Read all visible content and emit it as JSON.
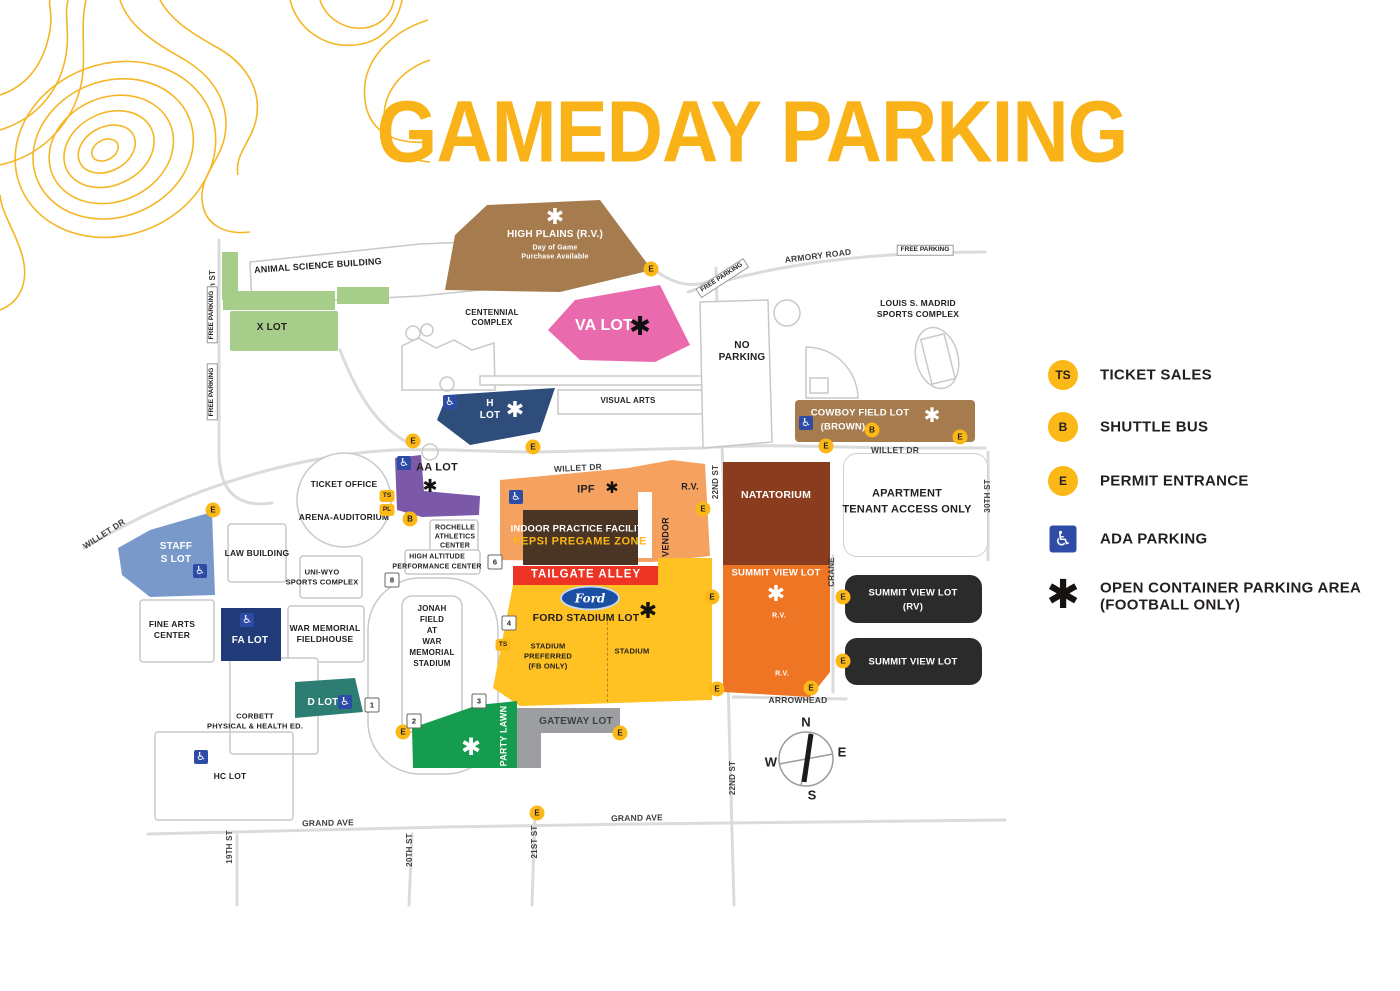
{
  "title": "GAMEDAY PARKING",
  "legend": {
    "ts_badge": "TS",
    "ts": "TICKET SALES",
    "b_badge": "B",
    "b": "SHUTTLE BUS",
    "e_badge": "E",
    "e": "PERMIT ENTRANCE",
    "ada": "ADA PARKING",
    "oc1": "OPEN CONTAINER PARKING AREA",
    "oc2": "(FOOTBALL ONLY)"
  },
  "markers": {
    "e": "E",
    "b": "B",
    "ts": "TS",
    "pl": "PL",
    "ada": "♿",
    "asterisk": "✱",
    "gate1": "1",
    "gate2": "2",
    "gate3": "3",
    "gate4": "4",
    "gate6": "6",
    "gate8": "8"
  },
  "lots": {
    "x": "X LOT",
    "hp_name": "HIGH PLAINS (R.V.)",
    "hp_note1": "Day of Game",
    "hp_note2": "Purchase Available",
    "va": "VA LOT",
    "h1": "H",
    "h2": "LOT",
    "aa": "AA LOT",
    "staff1": "STAFF",
    "staff2": "S LOT",
    "fa": "FA LOT",
    "d": "D LOT",
    "hc": "HC LOT",
    "cowboy1": "COWBOY FIELD LOT",
    "cowboy2": "(BROWN)",
    "ipf": "IPF",
    "ipf_rv": "R.V.",
    "vendor": "VENDOR",
    "natatorium": "NATATORIUM",
    "summit": "SUMMIT VIEW LOT",
    "summit_rv1": "R.V.",
    "summit_rv2": "R.V.",
    "apartment1": "APARTMENT",
    "apartment2": "TENANT ACCESS ONLY",
    "summit_black_rv1": "SUMMIT VIEW LOT",
    "summit_black_rv2": "(RV)",
    "summit_black": "SUMMIT VIEW LOT",
    "ipf_b1": "INDOOR PRACTICE FACILITY",
    "ipf_b2": "PEPSI PREGAME ZONE",
    "tailgate": "TAILGATE ALLEY",
    "ford_logo": "Ford",
    "ford": "FORD STADIUM LOT",
    "ford_l1": "STADIUM",
    "ford_l2": "PREFERRED",
    "ford_l3": "(FB ONLY)",
    "ford_r": "STADIUM",
    "party": "PARTY LAWN",
    "gateway": "GATEWAY LOT",
    "nop1": "NO",
    "nop2": "PARKING"
  },
  "buildings": {
    "animal": "ANIMAL SCIENCE BUILDING",
    "centennial1": "CENTENNIAL",
    "centennial2": "COMPLEX",
    "visual": "VISUAL ARTS",
    "ticket": "TICKET OFFICE",
    "arena": "ARENA-AUDITORIUM",
    "law": "LAW BUILDING",
    "uniwyo1": "UNI-WYO",
    "uniwyo2": "SPORTS COMPLEX",
    "rochelle1": "ROCHELLE",
    "rochelle2": "ATHLETICS",
    "rochelle3": "CENTER",
    "hapc1": "HIGH ALTITUDE",
    "hapc2": "PERFORMANCE CENTER",
    "jonah1": "JONAH",
    "jonah2": "FIELD",
    "jonah3": "AT",
    "jonah4": "WAR",
    "jonah5": "MEMORIAL",
    "jonah6": "STADIUM",
    "fieldhouse1": "WAR MEMORIAL",
    "fieldhouse2": "FIELDHOUSE",
    "finearts1": "FINE ARTS",
    "finearts2": "CENTER",
    "corbett1": "CORBETT",
    "corbett2": "PHYSICAL & HEALTH ED.",
    "madrid1": "LOUIS S. MADRID",
    "madrid2": "SPORTS COMPLEX"
  },
  "streets": {
    "armory": "ARMORY ROAD",
    "willet": "WILLET DR",
    "grand": "GRAND AVE",
    "arrowhead": "ARROWHEAD",
    "crane": "CRANE",
    "s19top": "19th ST",
    "s19": "19TH ST",
    "s20": "20TH ST",
    "s21": "21ST ST",
    "s22": "22ND ST",
    "s30": "30TH ST",
    "free": "FREE PARKING"
  },
  "compass": {
    "n": "N",
    "e": "E",
    "w": "W",
    "s": "S"
  },
  "colors": {
    "gold": "#F9B319",
    "green_light": "#A6CD89",
    "brown": "#A67C4F",
    "pink": "#E96BAE",
    "navy": "#2E4D7B",
    "purple": "#7B58A8",
    "staff_blue": "#7A99CB",
    "fa_navy": "#203B77",
    "teal": "#2E7D72",
    "orange_light": "#F5A15F",
    "rust": "#8A3D1E",
    "orange": "#EE7523",
    "black_lot": "#2B2B2B",
    "ford_gold": "#FFC222",
    "red": "#EE3424",
    "party_green": "#169C4E",
    "gray": "#9C9EA1",
    "ada_blue": "#2E4CA6"
  }
}
